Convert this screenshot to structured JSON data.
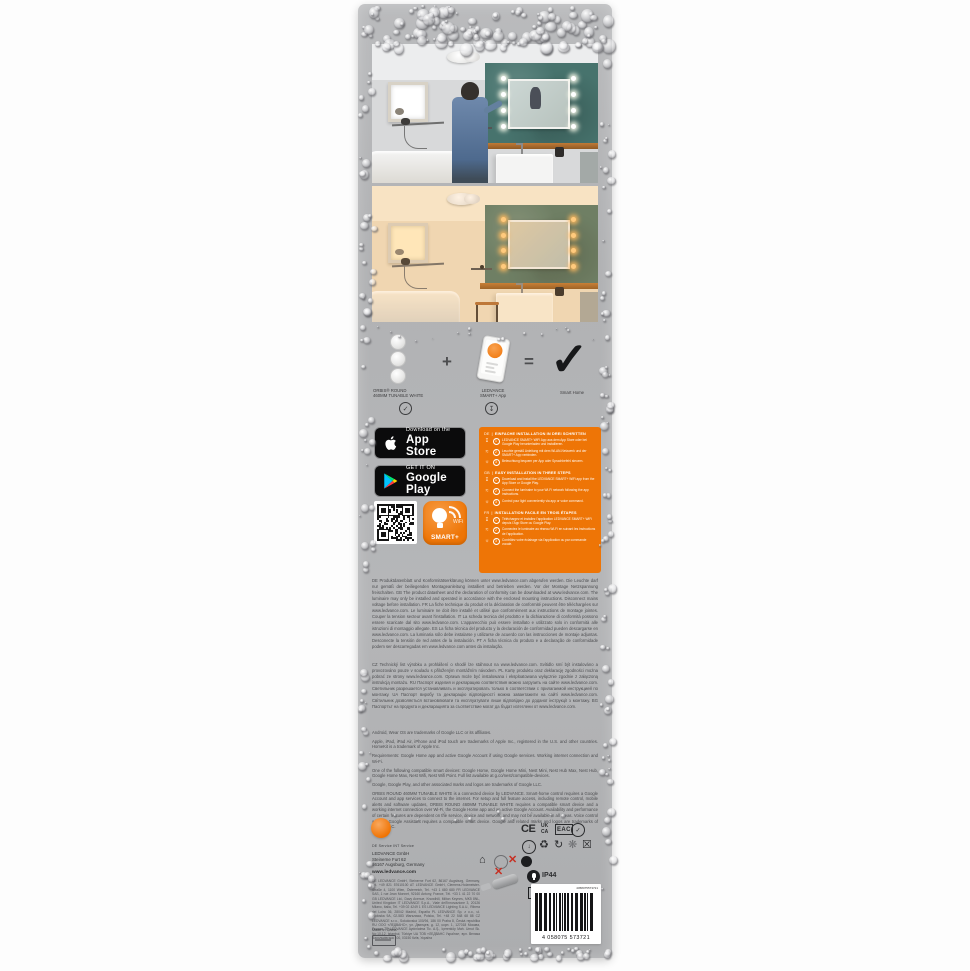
{
  "formula": {
    "product_label_line1": "ORBIS® ROUND",
    "product_label_line2": "460MM TUNABLE WHITE",
    "plus": "+",
    "app_label_line1": "LEDVANCE",
    "app_label_line2": "SMART+ App",
    "equals": "=",
    "result_label": "Smart Home",
    "check_glyph": "✓",
    "circled_check": "✓",
    "circled_download": "↧"
  },
  "badges": {
    "app_store_top": "Download on the",
    "app_store_main": "App Store",
    "google_play_top": "GET IT ON",
    "google_play_main": "Google Play"
  },
  "smart_plus_icon": {
    "wifi_label": "WiFi",
    "brand_label": "SMART+"
  },
  "instructions": {
    "sections": [
      {
        "code": "DE",
        "title": "EINFACHE INSTALLATION IN DREI SCHRITTEN",
        "steps": [
          {
            "n": "1",
            "icon": "download",
            "text": "LEDVANCE SMART+ WiFi App aus dem App Store oder bei Google Play herunterladen und installieren."
          },
          {
            "n": "2",
            "icon": "wifi",
            "text": "Leuchte gemäß Anleitung mit dem WLAN-Netzwerk und der SMART+ App verbinden."
          },
          {
            "n": "3",
            "icon": "bulb",
            "text": "Beleuchtung bequem per App oder Sprachbefehl steuern."
          }
        ]
      },
      {
        "code": "GB",
        "title": "EASY INSTALLATION IN THREE STEPS",
        "steps": [
          {
            "n": "1",
            "icon": "download",
            "text": "Download and install the LEDVANCE SMART+ WiFi app from the App Store or Google Play."
          },
          {
            "n": "2",
            "icon": "wifi",
            "text": "Connect the luminaire to your Wi-Fi network following the app instructions."
          },
          {
            "n": "3",
            "icon": "bulb",
            "text": "Control your light conveniently via app or voice command."
          }
        ]
      },
      {
        "code": "FR",
        "title": "INSTALLATION FACILE EN TROIS ÉTAPES",
        "steps": [
          {
            "n": "1",
            "icon": "download",
            "text": "Téléchargez et installez l'application LEDVANCE SMART+ WiFi depuis l'App Store ou Google Play."
          },
          {
            "n": "2",
            "icon": "wifi",
            "text": "Connectez le luminaire au réseau Wi-Fi en suivant les instructions de l'application."
          },
          {
            "n": "3",
            "icon": "bulb",
            "text": "Contrôlez votre éclairage via l'application ou par commande vocale."
          }
        ]
      }
    ]
  },
  "fine_print": {
    "block1": "DE Produktdatenblatt und Konformitätserklärung können unter www.ledvance.com abgerufen werden. Die Leuchte darf nur gemäß der beiliegenden Montageanleitung installiert und betrieben werden. Vor der Montage Netzspannung freischalten. GB The product datasheet and the declaration of conformity can be downloaded at www.ledvance.com. The luminaire may only be installed and operated in accordance with the enclosed mounting instructions. Disconnect mains voltage before installation. FR La fiche technique du produit et la déclaration de conformité peuvent être téléchargées sur www.ledvance.com. Le luminaire ne doit être installé et utilisé que conformément aux instructions de montage jointes. Couper la tension secteur avant l'installation. IT La scheda tecnica del prodotto e la dichiarazione di conformità possono essere scaricate dal sito www.ledvance.com. L'apparecchio può essere installato e utilizzato solo in conformità alle istruzioni di montaggio allegate. ES La ficha técnica del producto y la declaración de conformidad pueden descargarse en www.ledvance.com. La luminaria sólo debe instalarse y utilizarse de acuerdo con las instrucciones de montaje adjuntas. Desconecte la tensión de red antes de la instalación. PT A ficha técnica do produto e a declaração de conformidade podem ser descarregadas em www.ledvance.com antes da instalação.",
    "block2": "CZ Technický list výrobku a prohlášení o shodě lze stáhnout na www.ledvance.com. Svítidlo smí být instalováno a provozováno pouze v souladu s přiloženým montážním návodem. PL Kartę produktu oraz deklarację zgodności można pobrać ze strony www.ledvance.com. Oprawa może być instalowana i eksploatowana wyłącznie zgodnie z załączoną instrukcją montażu. RU Паспорт изделия и декларацию соответствия можно загрузить на сайте www.ledvance.com. Светильник разрешается устанавливать и эксплуатировать только в соответствии с прилагаемой инструкцией по монтажу. UA Паспорт виробу та декларацію відповідності можна завантажити на сайті www.ledvance.com. Світильник дозволяється встановлювати та експлуатувати лише відповідно до доданої інструкції з монтажу. BG Паспортът на продукта и декларацията за съответствие могат да бъдат изтеглени от www.ledvance.com.",
    "notices": [
      "Android, Wear OS are trademarks of Google LLC or its affiliates.",
      "Apple, iPad, iPad Air, iPhone and iPod touch are trademarks of Apple Inc., registered in the U.S. and other countries. HomeKit is a trademark of Apple Inc.",
      "Requirements: Google Home app and active Google Account if using Google services. Working internet connection and Wi-Fi.",
      "One of the following compatible smart devices: Google Home, Google Home Mini, Nest Mini, Nest Hub Max, Nest Hub, Google Home Max, Nest Wifi, Nest Wifi Point. Full list available at g.co/nest/compatible-devices.",
      "Google, Google Play, and other associated marks and logos are trademarks of Google LLC.",
      "ORBIS ROUND 460MM TUNABLE WHITE is a connected device by LEDVANCE. Smart-home control requires a Google Account and app services to connect to the internet. For setup and full feature access, including remote control, mobile alerts and software updates, ORBIS ROUND 460MM TUNABLE WHITE requires a compatible smart device and a working internet connection over Wi-Fi, the Google Home app and an active Google Account. Availability and performance of certain features are dependent on the service, device and network, and may not be available in all areas. Voice control with the Google Assistant requires a compatible smart device. Google and related marks and logos are trademarks of Google LLC."
    ]
  },
  "manufacturer": {
    "service_line": "DE Service      INT Service",
    "company": "LEDVANCE GmbH",
    "street": "Steinerne Furt 62",
    "city": "86167 Augsburg, Germany",
    "website": "www.ledvance.com",
    "address_lines": [
      "DE LEDVANCE GmbH, Steinerne Furt 62, 86167 Augsburg, Germany, Tel. +49 821 57610100",
      "AT LEDVANCE GmbH, Clemens-Holzmeister-Straße 4, 1100 Wien, Österreich, Tel. +43 1 680 680",
      "FR LEDVANCE SAS, 1 rue Jean Monnet, 92160 Antony, France, Tél. +33 1 41 22 70 00",
      "GB LEDVANCE Ltd., Davy Avenue, Knowlhill, Milton Keynes, MK5 8NL, United Kingdom",
      "IT LEDVANCE S.p.A., Viale dell'Innovazione 3, 20126 Milano, Italia, Tel. +39 02 4249 1",
      "ES LEDVANCE Lighting S.A.U., Ribera del Loira 36, 28042 Madrid, España",
      "PL LEDVANCE Sp. z o.o., ul. Wołoska 9A, 02-583 Warszawa, Polska, Tel. +48 22 548 68 88",
      "CZ LEDVANCE s.r.o., Sokolovská 100/94, 186 00 Praha 8, Česká republika",
      "RU ООО «ЛЕДВАНС», ул. Двинцев, д. 12, корп. 1, 127018 Москва, Россия",
      "TR LEDVANCE Aydınlatma Tic. A.Ş., İçerenköy Mah. Umut Sk. No:10-12, İstanbul, Türkiye",
      "UA ТОВ «ЛЕДВАНС Україна», вул. Велика Васильківська 100, 03150 Київ, Україна"
    ],
    "made_in": "Made in China"
  },
  "certifications": {
    "ce": "CE",
    "ukca_line1": "UK",
    "ukca_line2": "CA",
    "eac": "EAC",
    "ip_rating": "IP44"
  },
  "barcode": {
    "number_top": "4058075573721",
    "ean": "4 058075 573721"
  },
  "colors": {
    "brand_orange": "#ee7506",
    "package_grey": "#b3b4b6",
    "teal_wall": "#47736d"
  }
}
